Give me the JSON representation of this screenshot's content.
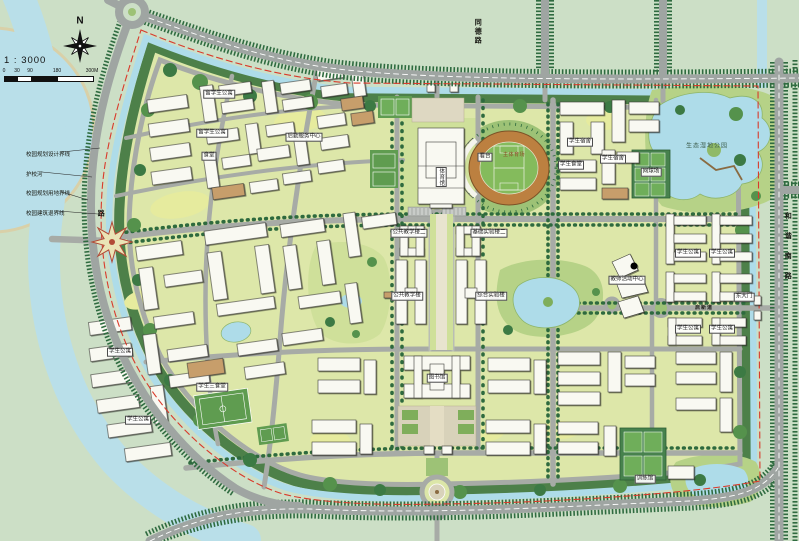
{
  "meta": {
    "compass_n": "N",
    "scale_ratio": "1 : 3000",
    "scale_ticks": [
      "0",
      "30",
      "90",
      "180",
      "300M"
    ]
  },
  "legend": [
    {
      "text": "校园规划设计界线"
    },
    {
      "text": "护校河"
    },
    {
      "text": "校园规划用地界线"
    },
    {
      "text": "校园建筑退界线"
    }
  ],
  "road_labels": [
    {
      "text": "同德路",
      "x": 477,
      "y": 32,
      "dir": "v",
      "cls": "road"
    },
    {
      "text": "和谐南路",
      "x": 787,
      "y": 252,
      "dir": "v",
      "cls": "road road-wide"
    },
    {
      "text": "启新道",
      "x": 704,
      "y": 308,
      "cls": "road-sm"
    },
    {
      "text": "路",
      "x": 100,
      "y": 214,
      "dir": "v",
      "cls": "road"
    }
  ],
  "site_labels": [
    {
      "text": "体育馆",
      "x": 441,
      "y": 177,
      "dir": "v"
    },
    {
      "text": "看台",
      "x": 485,
      "y": 157
    },
    {
      "text": "主体育场",
      "x": 514,
      "y": 155,
      "cls": "stadium"
    },
    {
      "text": "公共教学楼二",
      "x": 409,
      "y": 233
    },
    {
      "text": "基础实验楼二",
      "x": 489,
      "y": 233
    },
    {
      "text": "公共教学楼",
      "x": 407,
      "y": 296
    },
    {
      "text": "综合实验楼",
      "x": 491,
      "y": 296
    },
    {
      "text": "图书馆",
      "x": 437,
      "y": 378
    },
    {
      "text": "留学生公寓",
      "x": 219,
      "y": 94
    },
    {
      "text": "留学生公寓",
      "x": 212,
      "y": 133
    },
    {
      "text": "后勤服务中心",
      "x": 304,
      "y": 137
    },
    {
      "text": "食堂",
      "x": 209,
      "y": 156
    },
    {
      "text": "学生宿舍",
      "x": 580,
      "y": 142
    },
    {
      "text": "学生食堂",
      "x": 571,
      "y": 165
    },
    {
      "text": "学生宿舍",
      "x": 613,
      "y": 159
    },
    {
      "text": "网球场",
      "x": 651,
      "y": 172
    },
    {
      "text": "生态湿地公园",
      "x": 707,
      "y": 147,
      "cls": "park"
    },
    {
      "text": "教师活动中心",
      "x": 627,
      "y": 280
    },
    {
      "text": "学生公寓",
      "x": 688,
      "y": 253
    },
    {
      "text": "学生公寓",
      "x": 722,
      "y": 253
    },
    {
      "text": "学生公寓",
      "x": 688,
      "y": 329
    },
    {
      "text": "学生公寓",
      "x": 722,
      "y": 329
    },
    {
      "text": "训练馆",
      "x": 645,
      "y": 479
    },
    {
      "text": "学生三食堂",
      "x": 212,
      "y": 387
    },
    {
      "text": "学生公寓",
      "x": 120,
      "y": 352
    },
    {
      "text": "学生公寓",
      "x": 138,
      "y": 420
    },
    {
      "text": "东大门",
      "x": 744,
      "y": 297
    }
  ]
}
